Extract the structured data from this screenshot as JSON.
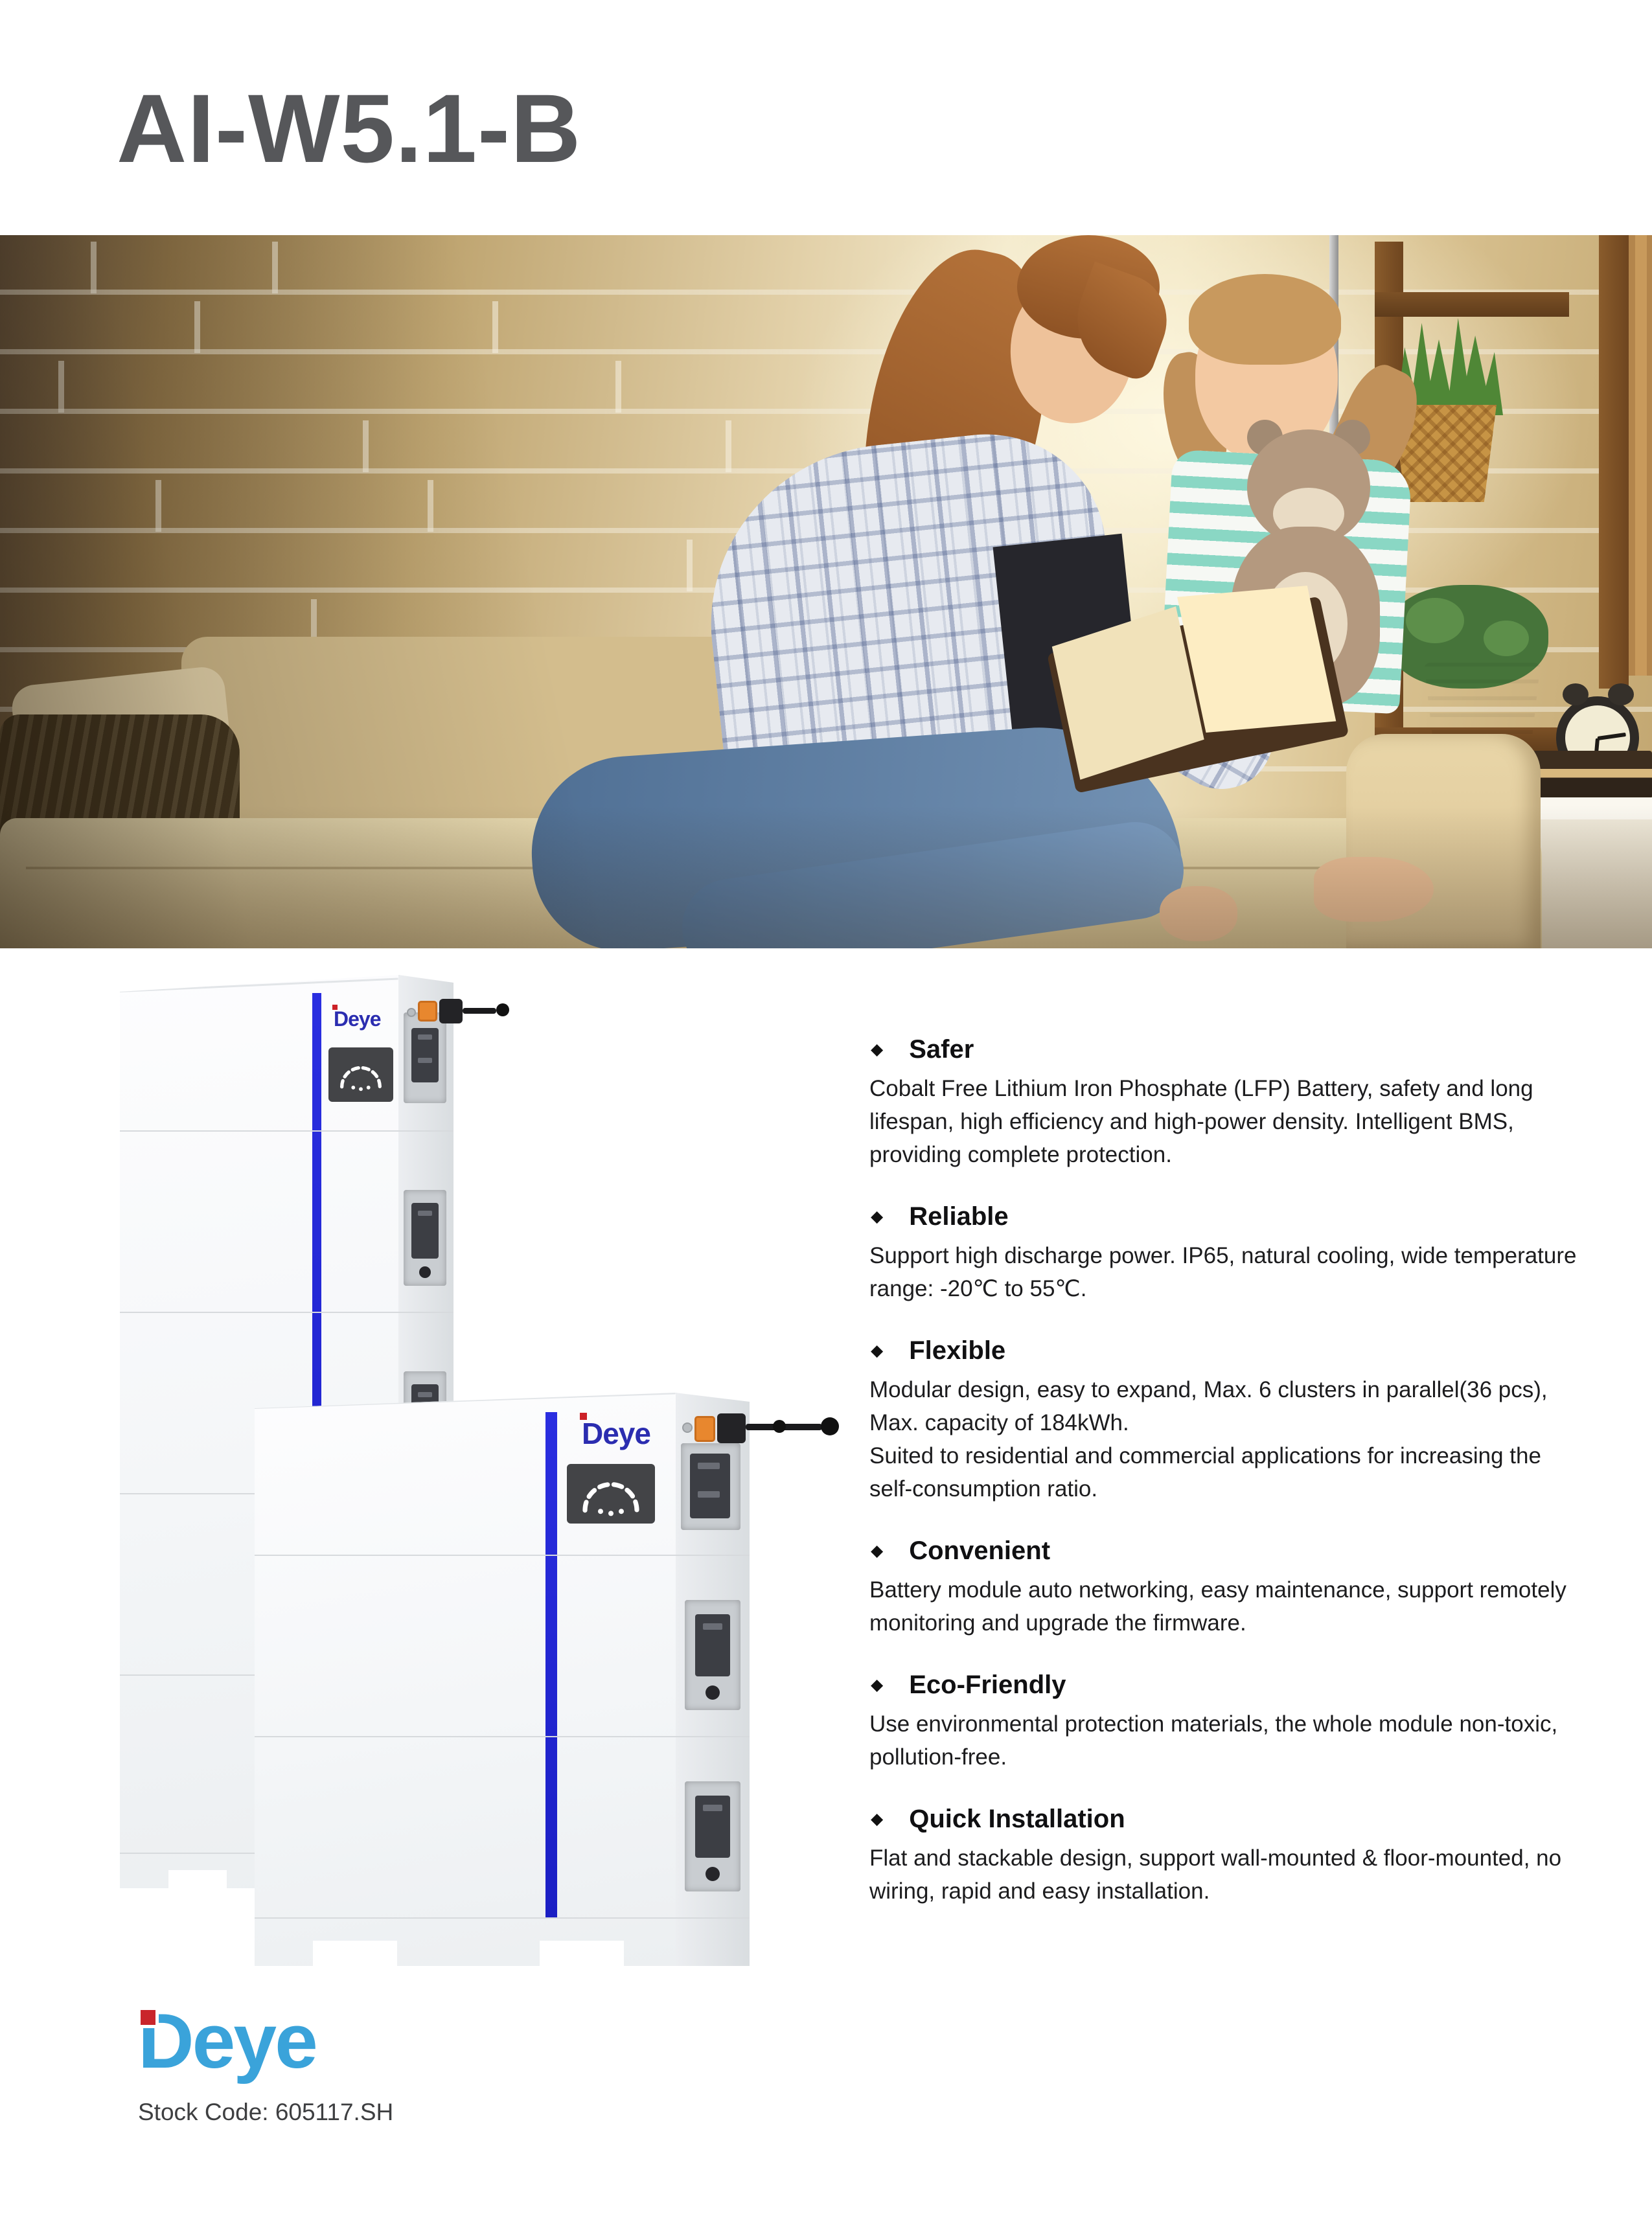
{
  "page": {
    "title": "AI-W5.1-B"
  },
  "brand": {
    "logo_text": "Deye",
    "stock_code": "Stock Code: 605117.SH"
  },
  "product": {
    "tower_logo_text": "Deye"
  },
  "feature_section": {
    "bullet": "◆",
    "items": [
      {
        "title": "Safer",
        "body": "Cobalt Free Lithium Iron Phosphate (LFP) Battery, safety and long lifespan, high efficiency and high-power density. Intelligent BMS, providing complete protection."
      },
      {
        "title": "Reliable",
        "body": "Support high discharge power. IP65, natural cooling, wide temperature range: -20℃ to 55℃."
      },
      {
        "title": "Flexible",
        "body": "Modular design, easy to expand, Max. 6 clusters in parallel(36 pcs), Max. capacity of 184kWh.",
        "body2": "Suited to residential and commercial applications for increasing the self-consumption ratio."
      },
      {
        "title": "Convenient",
        "body": "Battery module auto networking, easy maintenance, support remotely monitoring and upgrade the firmware."
      },
      {
        "title": "Eco-Friendly",
        "body": "Use environmental protection materials, the whole module non-toxic, pollution-free."
      },
      {
        "title": "Quick Installation",
        "body": "Flat and stackable design, support wall-mounted & floor-mounted, no wiring, rapid and easy installation."
      }
    ]
  },
  "colors": {
    "title_gray": "#56575a",
    "accent_blue_stripe": "#2226d8",
    "product_logo_blue": "#2b2db0",
    "deye_logo_blue": "#3aa3da",
    "deye_logo_red": "#c9252b"
  }
}
